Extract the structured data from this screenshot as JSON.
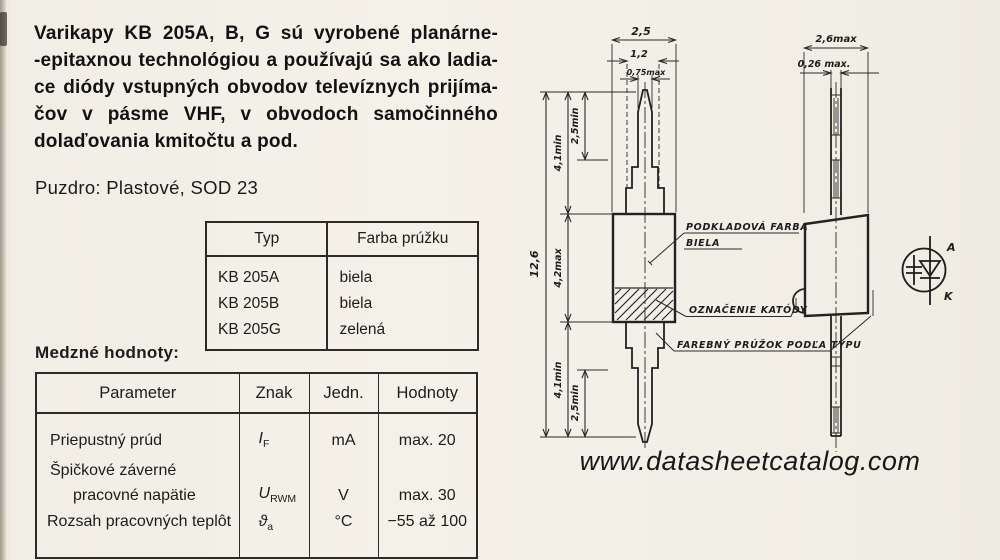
{
  "intro": {
    "lines": [
      "Varikapy KB 205A, B, G sú vyrobené planárne-",
      "-epitaxnou technológiou a používajú sa ako ladia-",
      "ce diódy vstupných obvodov televíznych prijíma-",
      "čov v pásme VHF, v obvodoch samočinného",
      "dolaďovania kmitočtu a pod."
    ]
  },
  "package_line": "Puzdro: Plastové, SOD 23",
  "type_table": {
    "headers": {
      "type": "Typ",
      "color": "Farba prúžku"
    },
    "rows": [
      {
        "type": "KB 205A",
        "color": "biela"
      },
      {
        "type": "KB 205B",
        "color": "biela"
      },
      {
        "type": "KB 205G",
        "color": "zelená"
      }
    ]
  },
  "limits": {
    "title": "Medzné hodnoty:",
    "headers": {
      "parameter": "Parameter",
      "symbol": "Znak",
      "unit": "Jedn.",
      "values": "Hodnoty"
    },
    "rows": [
      {
        "parameter": "Priepustný prúd",
        "sym": "I",
        "sub": "F",
        "unit": "mA",
        "value": "max. 20"
      },
      {
        "parameter_line1": "Špičkové záverné",
        "parameter_line2": "pracovné napätie",
        "sym": "U",
        "sub": "RWM",
        "unit": "V",
        "value": "max. 30"
      },
      {
        "parameter": "Rozsah pracovných teplôt",
        "sym": "ϑ",
        "sub": "a",
        "unit": "°C",
        "value": "−55 až 100"
      }
    ]
  },
  "drawing": {
    "front": {
      "width_top": "2,5",
      "width_mid": "1,2",
      "width_lead": "0,75max",
      "len_total": "12,6",
      "len_lead_top": "4,1min",
      "len_tip_top": "2,5min",
      "len_body": "4,2max",
      "len_lead_bot": "4,1min",
      "len_tip_bot": "2,5min"
    },
    "side": {
      "width_body": "2,6max",
      "width_lead": "0,26 max."
    },
    "annotations": {
      "base_color_line1": "PODKLADOVÁ FARBA",
      "base_color_line2": "BIELA",
      "cathode_mark": "OZNAČENIE KATÓDY",
      "color_stripe": "FAREBNÝ PRÚŽOK PODĽA TYPU"
    },
    "symbol": {
      "anode": "A",
      "cathode": "K"
    }
  },
  "watermark": "www.datasheetcatalog.com"
}
